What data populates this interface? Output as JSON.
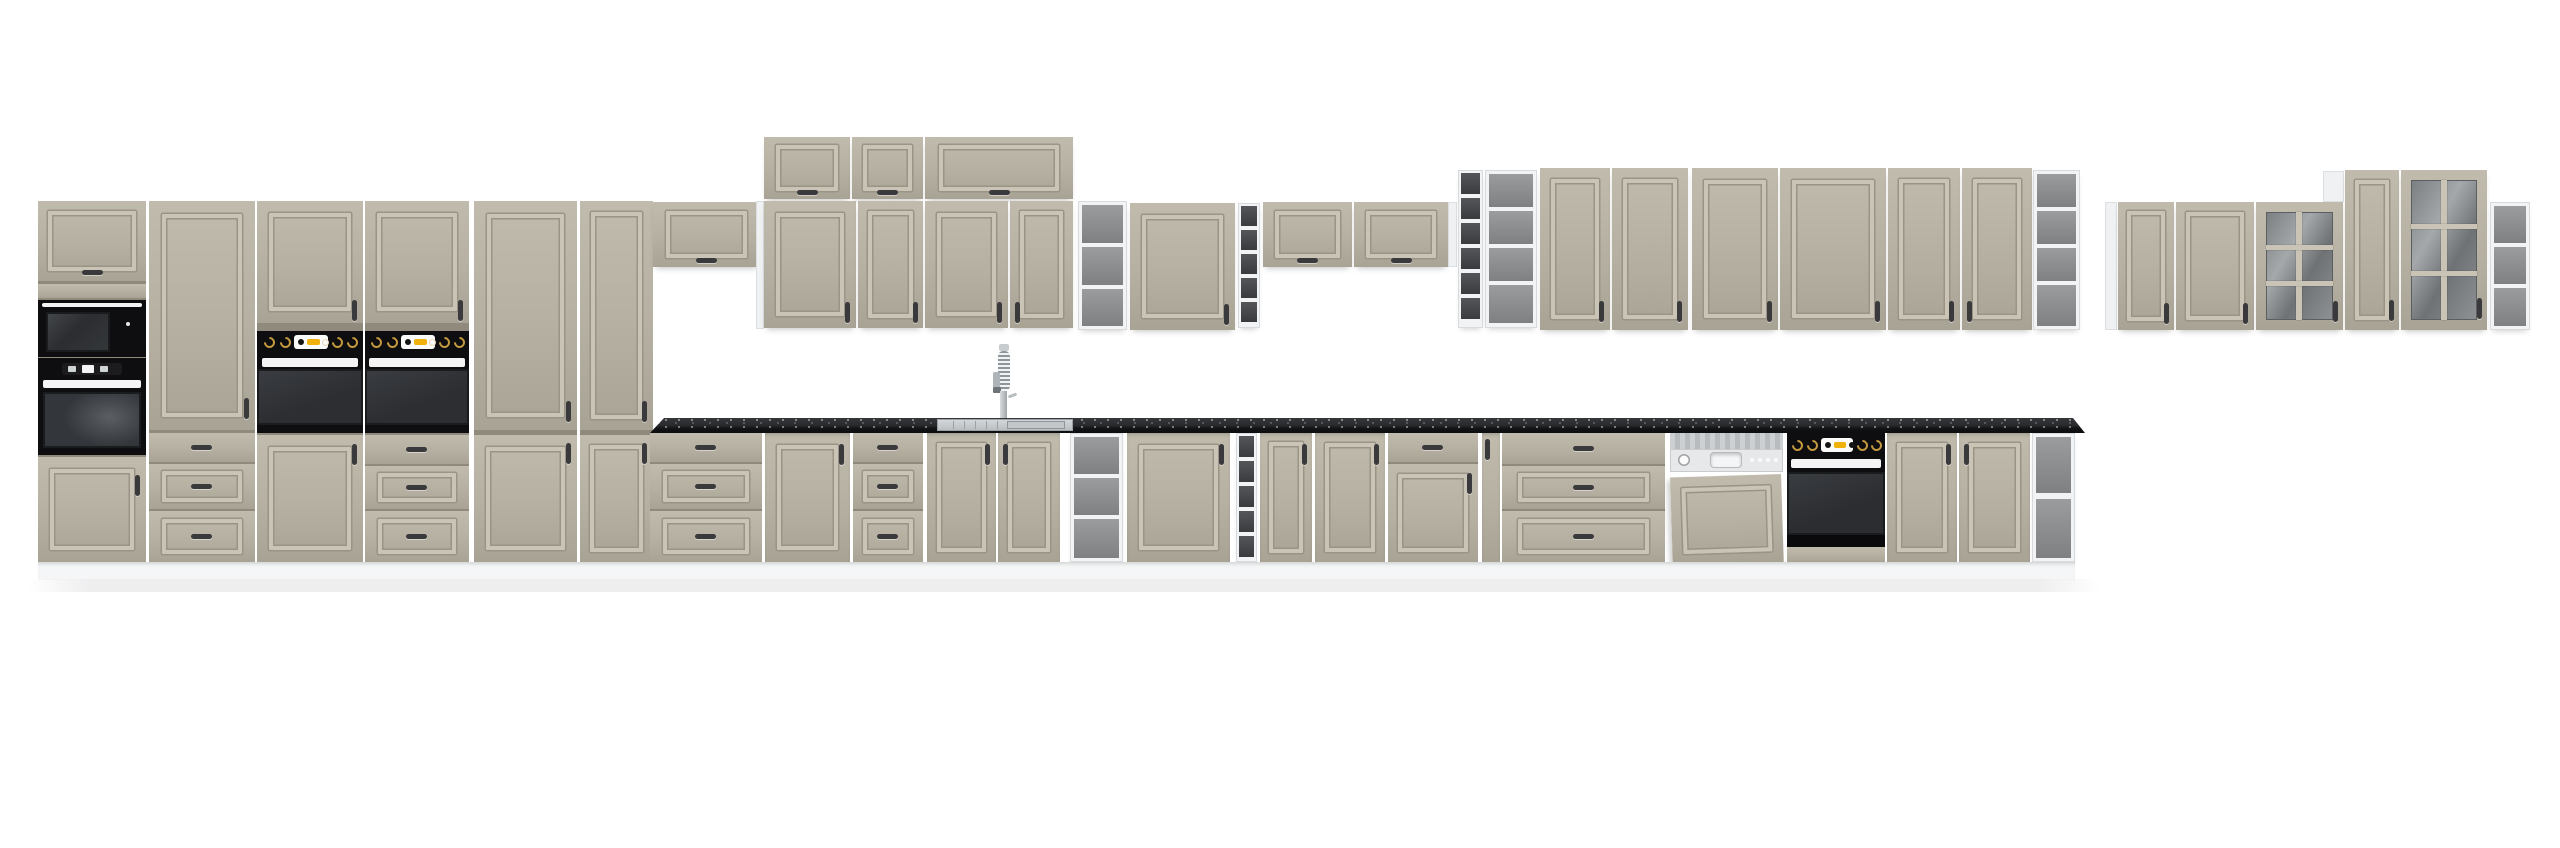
{
  "meta": {
    "title": "Modular classic kitchen cabinet set — product render",
    "background": "#ffffff"
  },
  "palette": {
    "face": "#b5b0a1",
    "faceLight": "#c0bbac",
    "faceShade": "#a8a394",
    "seam": "#8f8a7c",
    "moldDark": "#9a9486",
    "moldLight": "#c9c4b5",
    "carcass": "#eff1f2",
    "interiorMid": "#85878a",
    "interiorDark": "#3e3f43",
    "counterTop": "#2c2d31",
    "counterFace": "#101113",
    "applianceBlack": "#0e0e10",
    "ovenDoor": "#2f3236",
    "handleDark": "#3a3a3c",
    "handleWhite": "#f4f4f5",
    "gold": "#c59a3f",
    "amber": "#f0b10a",
    "steel": "#c6c9cc",
    "plinth": "#f5f6f7",
    "floor": "#eeeeef"
  },
  "finish": {
    "door_color": "clay / taupe",
    "door_style": "classic framed moulded front",
    "carcass_color": "white",
    "handle": "dark metal bow handle",
    "countertop": "black speckled stone effect"
  },
  "appliances": {
    "microwave": {
      "name": "built-in microwave",
      "color": "black"
    },
    "compact_oven": {
      "name": "compact built-in oven with display",
      "color": "black"
    },
    "wall_oven": {
      "name": "built-in oven with knob panel",
      "count": 2,
      "color": "black"
    },
    "under_counter_oven": {
      "name": "built-under oven",
      "color": "black"
    },
    "dishwasher": {
      "name": "semi-integrated dishwasher with furniture panel",
      "panel": "stainless / grey"
    },
    "sink": {
      "name": "inset stainless sink with drainer"
    },
    "faucet": {
      "name": "spring-neck kitchen mixer tap",
      "material": "stainless"
    }
  },
  "inventory": {
    "left_tall_block": [
      "appliance column: flip door + microwave + compact oven + door",
      "tall door over 3 drawers",
      "oven housing: door + built-in oven + door",
      "oven housing: door + built-in oven + 3 drawers"
    ],
    "tall_pantry": [
      "two-door larder",
      "two-door larder"
    ],
    "wall_run": [
      "flip-up wall cabinet",
      "3 flip-up top boxes",
      "4 framed wall doors",
      "open end shelf",
      "single wall door",
      "narrow open tower",
      "flip-up wall cabinet",
      "flip-up wall cabinet",
      "narrow open tower",
      "wide open tower",
      "6 framed wall doors",
      "open end shelf"
    ],
    "right_wall_group": [
      "wall door",
      "wall door",
      "glass mullion door",
      "tall wall door",
      "tall glass mullion door",
      "open end shelf"
    ],
    "base_run": [
      "3-drawer base",
      "door base",
      "3-drawer base",
      "double-door sink base",
      "open shelf base",
      "wide door base",
      "narrow open tower",
      "door base",
      "door base",
      "drawer+door base",
      "narrow filler door",
      "wide 3-drawer base",
      "dishwasher",
      "built-under oven",
      "double-door base",
      "open end shelf base"
    ]
  }
}
